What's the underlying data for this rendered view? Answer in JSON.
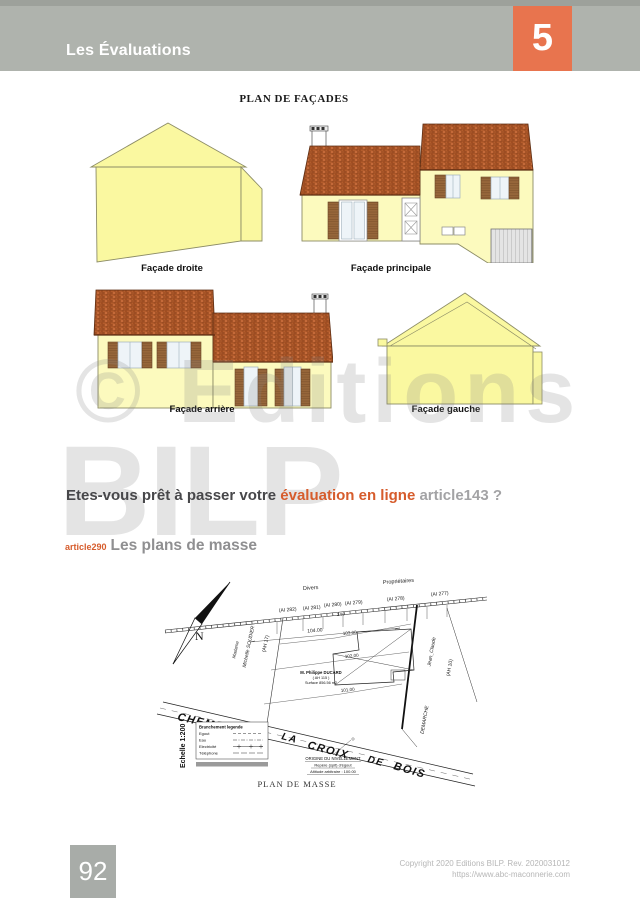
{
  "header": {
    "title": "Les Évaluations",
    "chapter_number": "5",
    "bar_color": "#afb3ad",
    "accent_color": "#e8744e"
  },
  "facades_figure": {
    "title": "PLAN DE FAÇADES",
    "items": [
      {
        "label": "Façade droite"
      },
      {
        "label": "Façade principale"
      },
      {
        "label": "Façade arrière"
      },
      {
        "label": "Façade gauche"
      }
    ],
    "wall_color": "#fbf9b4",
    "roof_color": "#b35c2c",
    "shutter_color": "#96663a"
  },
  "watermark": {
    "line1": "© Editions",
    "line2": "BILP"
  },
  "cta": {
    "prefix": "Etes-vous prêt à passer votre ",
    "highlight": "évaluation en ligne",
    "suffix": " article143 ?"
  },
  "section_heading": {
    "article_ref": "article290",
    "title": "Les plans de masse"
  },
  "site_plan": {
    "caption": "PLAN DE MASSE",
    "north_label": "N",
    "scale_label": "Echelle 1:200",
    "top_labels": {
      "divers": "Divers",
      "proprietaires": "Propriétaires"
    },
    "parcels": [
      "(AI 282)",
      "(AI 281)",
      "(AI 280)",
      "(AI 279)",
      "(AI 278)",
      "(AI 277)"
    ],
    "dimensions": {
      "main": "104.00",
      "secondary": "2.93"
    },
    "contours": [
      "103.00",
      "102.00",
      "101.00"
    ],
    "neighbor_left": [
      "Madame",
      "Michelle SOUDIER",
      "(AH 17)"
    ],
    "neighbor_right": [
      "Jean_Claude",
      "DEMARCHE",
      "(AH 10)"
    ],
    "owner": [
      "M. Philippe DUCARD",
      "( AH 115 )",
      "Surface 856.56 m2"
    ],
    "road_words": [
      "CHEMIN",
      "DE",
      "LA",
      "CROIX",
      "DE",
      "BOIS"
    ],
    "legend": {
      "title": "Branchement legende",
      "items": [
        "Egout",
        "Eau",
        "Electricité",
        "Téléphone"
      ]
    },
    "levelling": [
      "ORIGINE DU NIVELLEMENT",
      "Repère (spit) d'égout",
      "Altitude arbitraire : 100.00"
    ]
  },
  "footer": {
    "page_number": "92",
    "copyright_line1": "Copyright 2020 Editions BILP. Rev. 2020031012",
    "copyright_line2": "https://www.abc-maconnerie.com"
  }
}
